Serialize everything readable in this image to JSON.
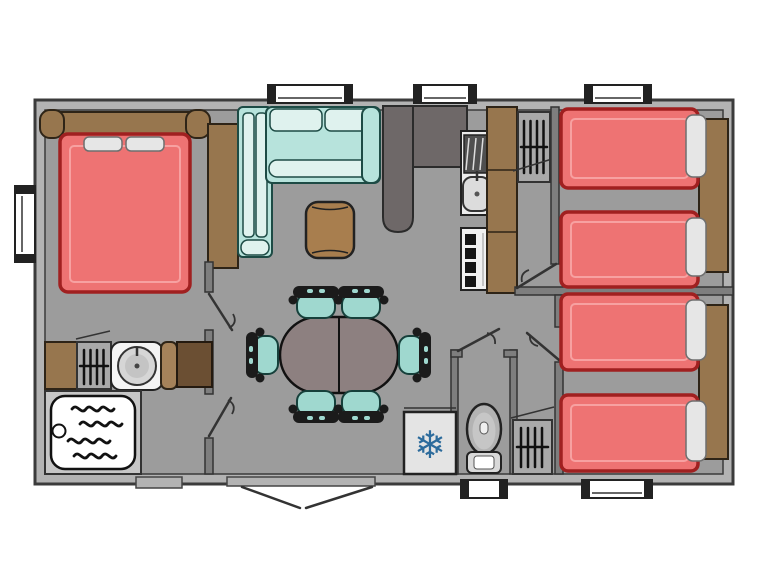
{
  "meta": {
    "view": "floor-plan-top-view",
    "subject": "mobile-home layout"
  },
  "icons": {
    "snowflake_glyph": "❄"
  },
  "colors": {
    "floor": "#9c9c9c",
    "wall_band": "#b3b3b3",
    "wall_line": "#3b3b3b",
    "partition_dark": "#6e6868",
    "wood": "#97764e",
    "wood_light": "#a5825a",
    "wood_dark": "#6b4f33",
    "mattress": "#ee7373",
    "mattress_edge": "#a02020",
    "pillow": "#e6e6e6",
    "sofa": "#b7e3dc",
    "sofa_highlight": "#dff2ee",
    "sofa_outline": "#1d4b45",
    "chair_seat": "#9fd8cf",
    "table": "#8d8080",
    "ottoman": "#a87e4e",
    "fixture_gray": "#a9a9a9",
    "snowflake": "#2c6b9c"
  },
  "rooms": [
    {
      "name": "master-bedroom",
      "items": [
        "double-bed",
        "pillow",
        "pillow",
        "headboard",
        "wardrobe",
        "side-window"
      ]
    },
    {
      "name": "bathroom",
      "items": [
        "shower-tray",
        "round-washbasin",
        "vanity",
        "towel-rail-cabinet",
        "storage-cabinets"
      ]
    },
    {
      "name": "living-dining",
      "items": [
        "corner-sofa",
        "tall-cabinet",
        "barrel-ottoman",
        "oval-dining-table",
        "dining-chair",
        "dining-chair",
        "dining-chair",
        "dining-chair",
        "dining-chair",
        "dining-chair",
        "entrance-double-door"
      ]
    },
    {
      "name": "kitchen",
      "items": [
        "dark-partition",
        "worktop",
        "sink-with-drainer",
        "four-burner-hob",
        "vent-cabinet"
      ]
    },
    {
      "name": "wc",
      "items": [
        "toilet"
      ]
    },
    {
      "name": "hallway",
      "items": [
        "fridge-freezer",
        "water-heater-cabinet"
      ]
    },
    {
      "name": "bedroom-twin-top",
      "items": [
        "single-bed",
        "single-bed",
        "pillow",
        "pillow",
        "headboard-panel"
      ]
    },
    {
      "name": "bedroom-twin-bottom",
      "items": [
        "single-bed",
        "single-bed",
        "pillow",
        "pillow",
        "headboard-panel"
      ]
    }
  ],
  "counts": {
    "windows": 6,
    "interior_doors": 5,
    "entrance_doors": 1,
    "single_beds": 4,
    "double_beds": 1,
    "dining_chairs": 6
  }
}
